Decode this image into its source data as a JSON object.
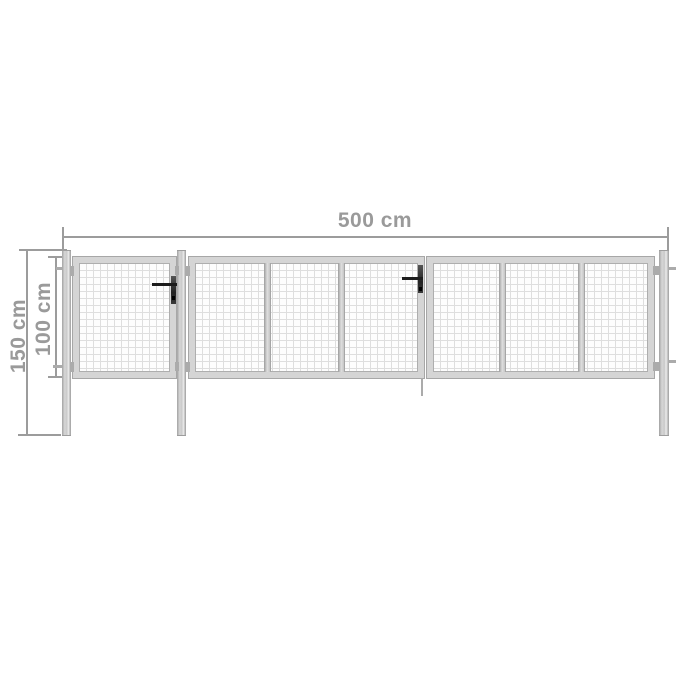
{
  "diagram": {
    "subject": "garden-gate-with-mesh-panels",
    "background": "#ffffff"
  },
  "dimensions": {
    "width": {
      "label": "500 cm"
    },
    "height_total": {
      "label": "150 cm"
    },
    "height_gate": {
      "label": "100 cm"
    }
  },
  "colors": {
    "dimension_lines": "#9c9c9c",
    "label_text": "#9a9a9a",
    "frame_fill": "#d5d5d5",
    "frame_edge": "#a7a7a7",
    "mesh_lines": "#dedede",
    "post_fill": "#c6c6c6",
    "handle": "#1c1c1c"
  },
  "structure": {
    "posts_count": 3,
    "gate_sections": [
      {
        "name": "pedestrian-gate",
        "mesh_panels": 1,
        "has_handle": true
      },
      {
        "name": "double-gate-left-leaf",
        "mesh_panels": 3,
        "has_handle": true
      },
      {
        "name": "double-gate-right-leaf",
        "mesh_panels": 3,
        "has_handle": false
      }
    ]
  }
}
